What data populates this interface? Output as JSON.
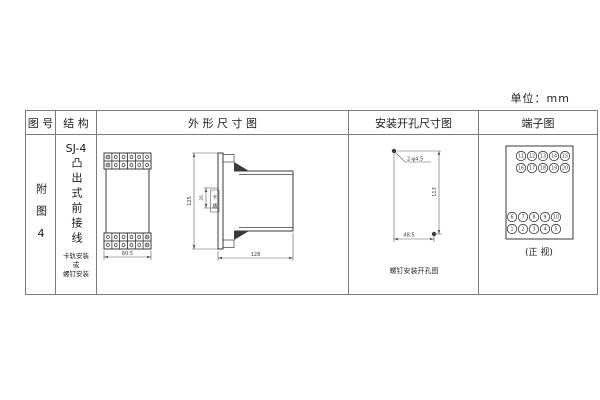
{
  "units_label": "单位：mm",
  "headers": {
    "fig_no": "图 号",
    "structure": "结 构",
    "outline": "外 形 尺 寸 图",
    "mounting": "安装开孔尺寸图",
    "terminal": "端子图"
  },
  "fig_column": {
    "label": "附图4"
  },
  "structure_column": {
    "model": "SJ-4",
    "type_vertical": "凸出式前接线",
    "note_line1": "卡轨安装",
    "note_line2": "或",
    "note_line3": "螺钉安装"
  },
  "outline_drawing": {
    "front_width": "60.5",
    "side_height": "125",
    "slot_height": "35",
    "slot_label": "卡槽",
    "side_depth": "128"
  },
  "mounting_drawing": {
    "hole_spec": "2-φ4.5",
    "vertical_spacing": "113",
    "horizontal_spacing": "48.5",
    "caption": "螺钉安装开孔图"
  },
  "terminal_diagram": {
    "rows": [
      [
        "11",
        "12",
        "13",
        "14",
        "15"
      ],
      [
        "16",
        "17",
        "18",
        "19",
        "20"
      ],
      [
        "6",
        "7",
        "8",
        "9",
        "10"
      ],
      [
        "1",
        "2",
        "3",
        "4",
        "5"
      ]
    ],
    "caption": "(正 视)"
  },
  "colors": {
    "line": "#3a3a3a",
    "table_border": "#7b7b7b",
    "background": "#ffffff"
  }
}
